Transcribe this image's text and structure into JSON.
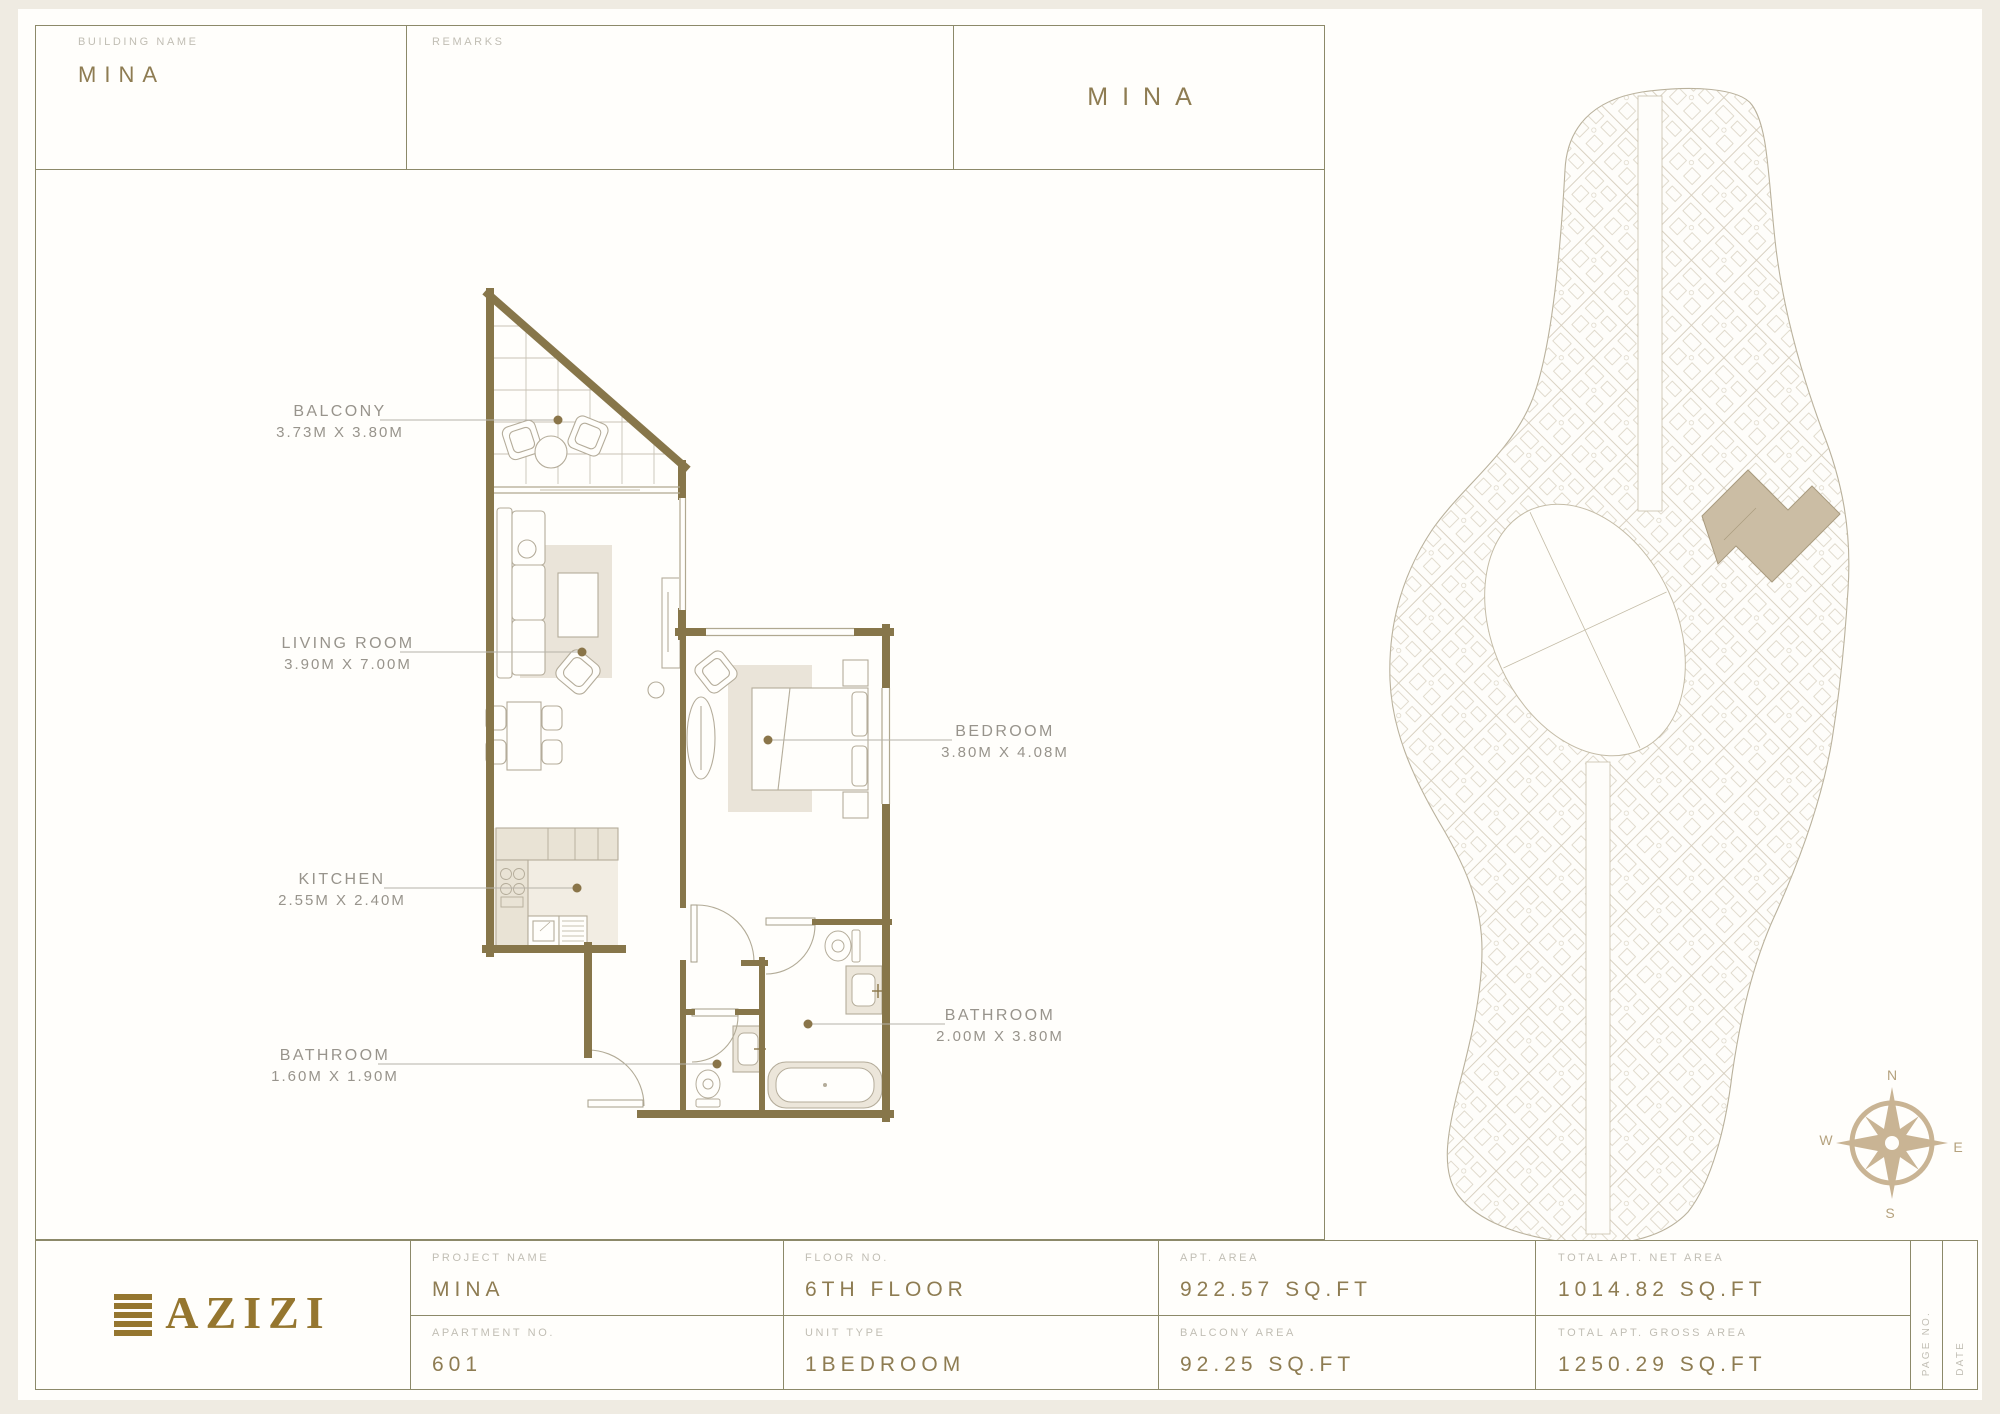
{
  "header": {
    "building_name_label": "BUILDING NAME",
    "building_name_value": "MINA",
    "remarks_label": "REMARKS",
    "sheet_title": "MINA"
  },
  "floor_plan": {
    "rooms": [
      {
        "name": "BALCONY",
        "dims": "3.73M X 3.80M"
      },
      {
        "name": "LIVING ROOM",
        "dims": "3.90M X 7.00M"
      },
      {
        "name": "KITCHEN",
        "dims": "2.55M X 2.40M"
      },
      {
        "name": "BATHROOM",
        "dims": "1.60M X 1.90M"
      },
      {
        "name": "BEDROOM",
        "dims": "3.80M X 4.08M"
      },
      {
        "name": "BATHROOM",
        "dims": "2.00M X 3.80M"
      }
    ],
    "wall_color": "#87764a",
    "fixture_fill_color": "#ece6da"
  },
  "site_plan": {
    "compass": {
      "n": "N",
      "e": "E",
      "s": "S",
      "w": "W"
    },
    "highlight_color": "#cbbda4",
    "line_color": "#c4bca7"
  },
  "title_block": {
    "logo_text": "AZIZI",
    "logo_color": "#95762f",
    "cells": [
      {
        "label": "PROJECT NAME",
        "value": "MINA"
      },
      {
        "label": "APARTMENT NO.",
        "value": "601"
      },
      {
        "label": "FLOOR NO.",
        "value": "6TH FLOOR"
      },
      {
        "label": "UNIT TYPE",
        "value": "1BEDROOM"
      },
      {
        "label": "APT. AREA",
        "value": "922.57 SQ.FT"
      },
      {
        "label": "BALCONY AREA",
        "value": "92.25 SQ.FT"
      },
      {
        "label": "TOTAL APT. NET AREA",
        "value": "1014.82 SQ.FT"
      },
      {
        "label": "TOTAL APT. GROSS AREA",
        "value": "1250.29 SQ.FT"
      }
    ],
    "page_no_label": "PAGE NO.",
    "date_label": "DATE",
    "accent_color": "#8e7c52",
    "frame_color": "#8c8969"
  }
}
